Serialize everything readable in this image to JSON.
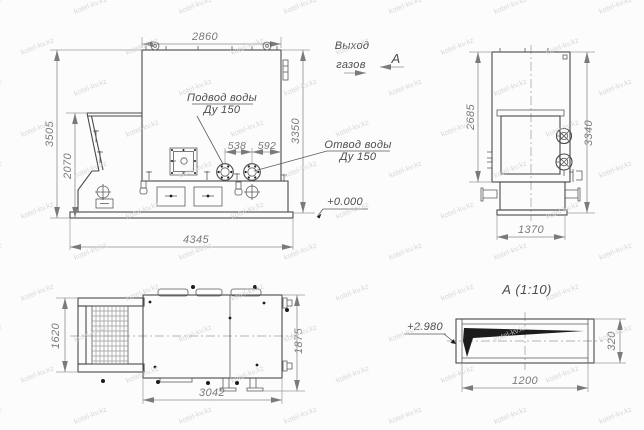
{
  "watermark": {
    "text": "kotel-kv.kz"
  },
  "front_view": {
    "dim_top": "2860",
    "dim_left_outer": "3505",
    "dim_left_inner": "2070",
    "dim_right": "3350",
    "dim_bottom": "4345",
    "dim_flange_spacing": "538",
    "dim_flange_to_edge": "592",
    "water_supply_line1": "Подвод воды",
    "water_supply_line2": "Ду 150",
    "elevation_zero": "+0.000"
  },
  "gas_outlet": {
    "line1": "Выход",
    "line2": "газов"
  },
  "view_arrow_label": "А",
  "water_return": {
    "line1": "Отвод воды",
    "line2": "Ду 150"
  },
  "side_view": {
    "dim_left": "2685",
    "dim_right": "3340",
    "dim_bottom": "1370"
  },
  "plan_view": {
    "dim_left": "1620",
    "dim_right": "1875",
    "dim_bottom": "3042"
  },
  "section_a": {
    "title": "А (1:10)",
    "dim_right": "320",
    "dim_bottom": "1200",
    "elevation": "+2.980"
  }
}
